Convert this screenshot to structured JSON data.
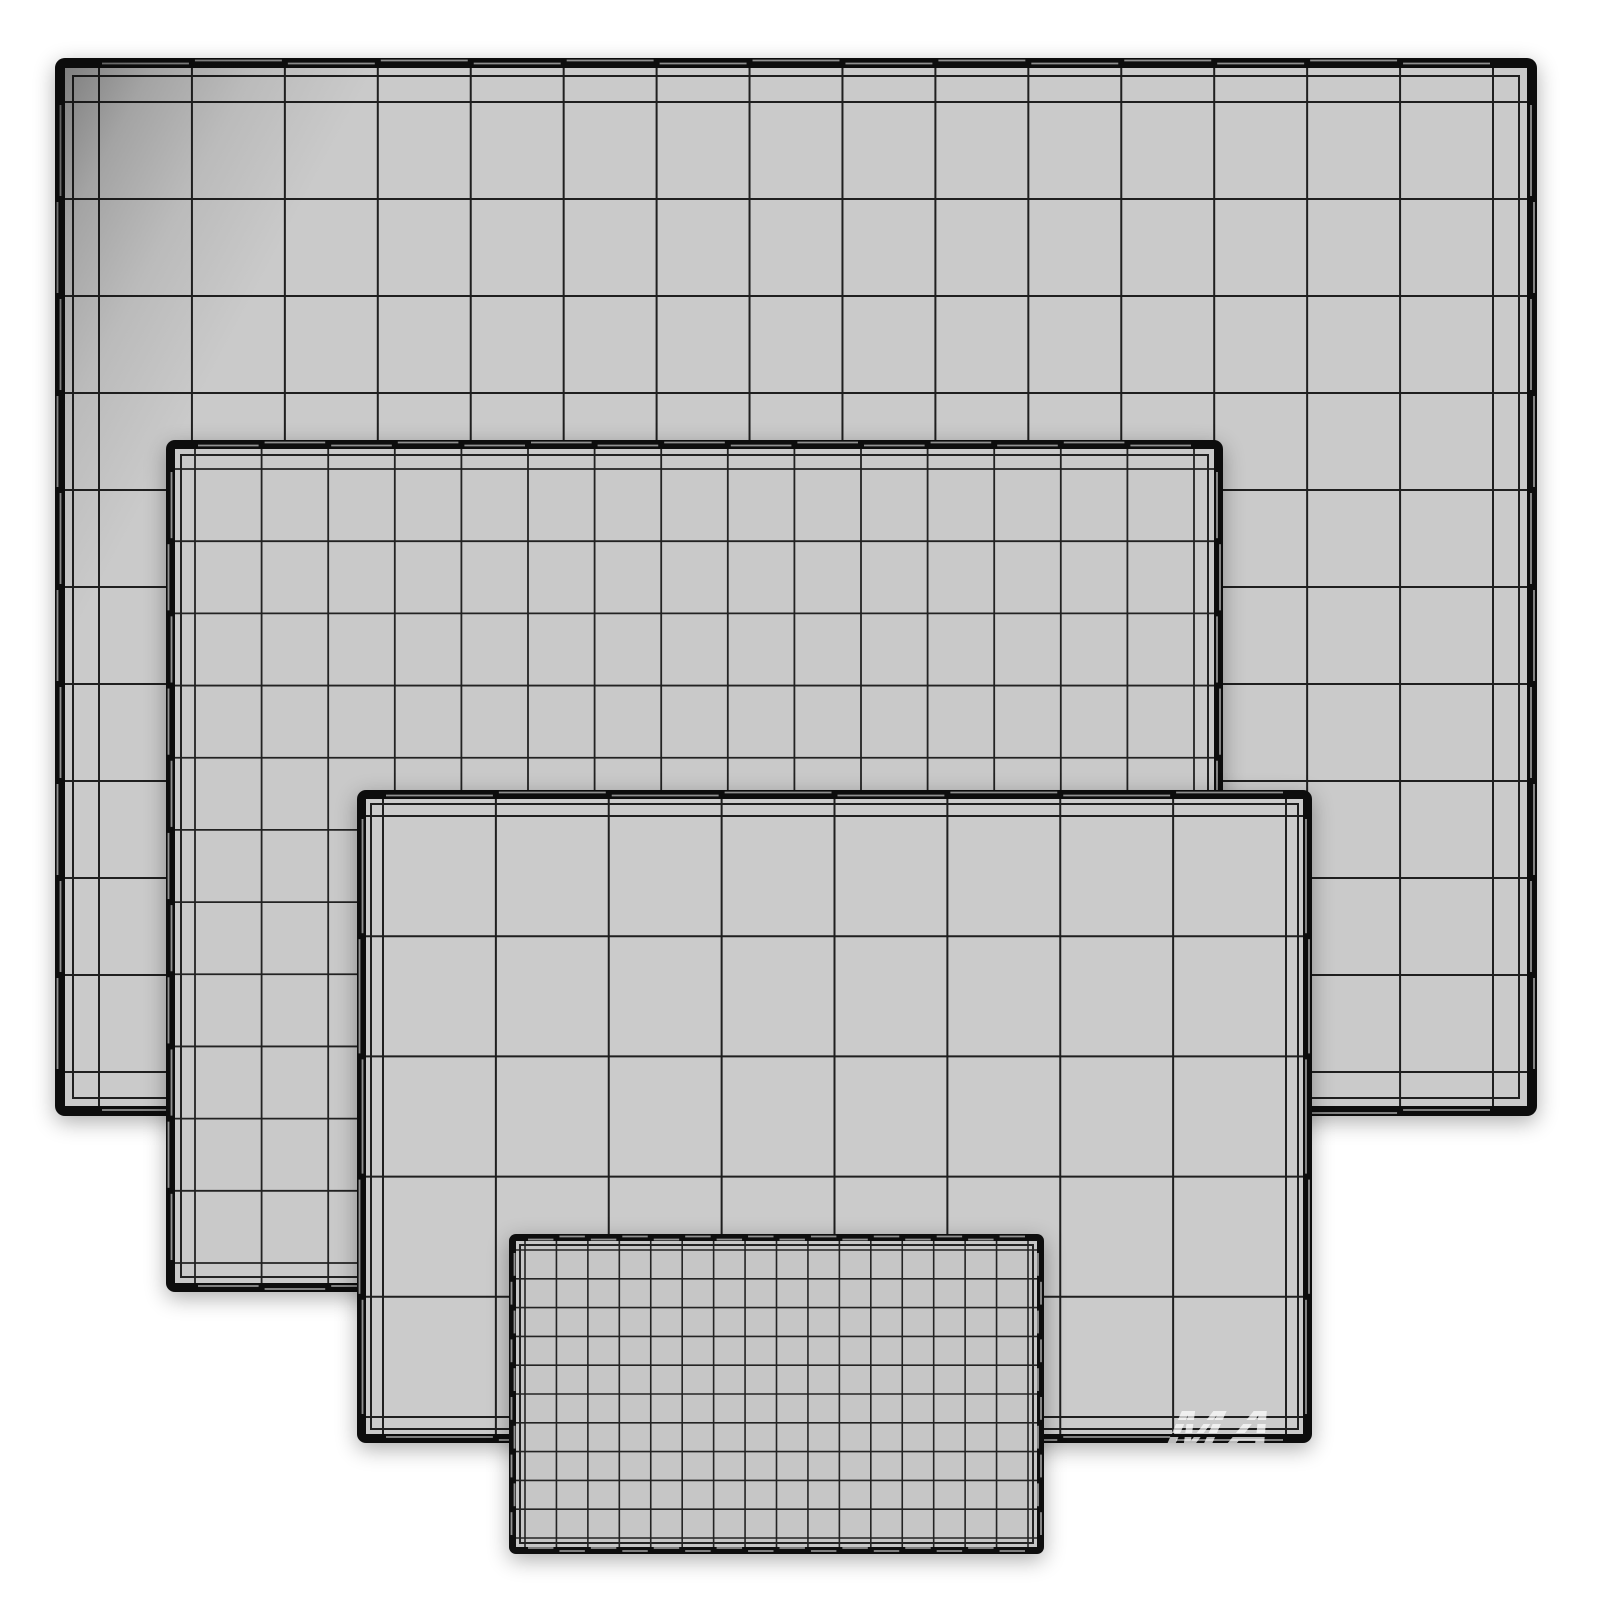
{
  "scene": {
    "background": "#ffffff",
    "description": "wireframe-preview-of-four-flat-screen-panels",
    "panels": [
      {
        "name": "panel-large-back",
        "x": 55,
        "y": 58,
        "w": 1482,
        "h": 1058,
        "z": 1,
        "border_w": 10,
        "radius": 10,
        "edge": 34,
        "inset": 8,
        "cols": 15,
        "rows": 10,
        "fill": "#cacaca",
        "border_color": "#0d0d0d",
        "line_color": "#1f1f1f",
        "line_w": 2,
        "corner_shade": true
      },
      {
        "name": "panel-medium",
        "x": 166,
        "y": 440,
        "w": 1057,
        "h": 852,
        "z": 2,
        "border_w": 9,
        "radius": 9,
        "edge": 20,
        "inset": 6,
        "cols": 15,
        "rows": 11,
        "fill": "#c9c9c9",
        "border_color": "#0d0d0d",
        "line_color": "#222222",
        "line_w": 1.8,
        "corner_shade": false
      },
      {
        "name": "panel-wide",
        "x": 357,
        "y": 790,
        "w": 955,
        "h": 653,
        "z": 3,
        "border_w": 9,
        "radius": 9,
        "edge": 17,
        "inset": 5,
        "cols": 8,
        "rows": 5,
        "fill": "#cbcbcb",
        "border_color": "#0d0d0d",
        "line_color": "#1f1f1f",
        "line_w": 2,
        "corner_shade": false
      },
      {
        "name": "panel-small-dense",
        "x": 509,
        "y": 1234,
        "w": 535,
        "h": 320,
        "z": 4,
        "border_w": 7,
        "radius": 7,
        "edge": 9,
        "inset": 4,
        "cols": 16,
        "rows": 10,
        "fill": "#c6c6c6",
        "border_color": "#0e0e0e",
        "line_color": "#232323",
        "line_w": 1.6,
        "corner_shade": false
      }
    ],
    "watermark": {
      "text": "MA",
      "x": 1168,
      "y": 1398,
      "font_size": 64,
      "color": "#ffffff",
      "opacity": 0.72
    }
  }
}
